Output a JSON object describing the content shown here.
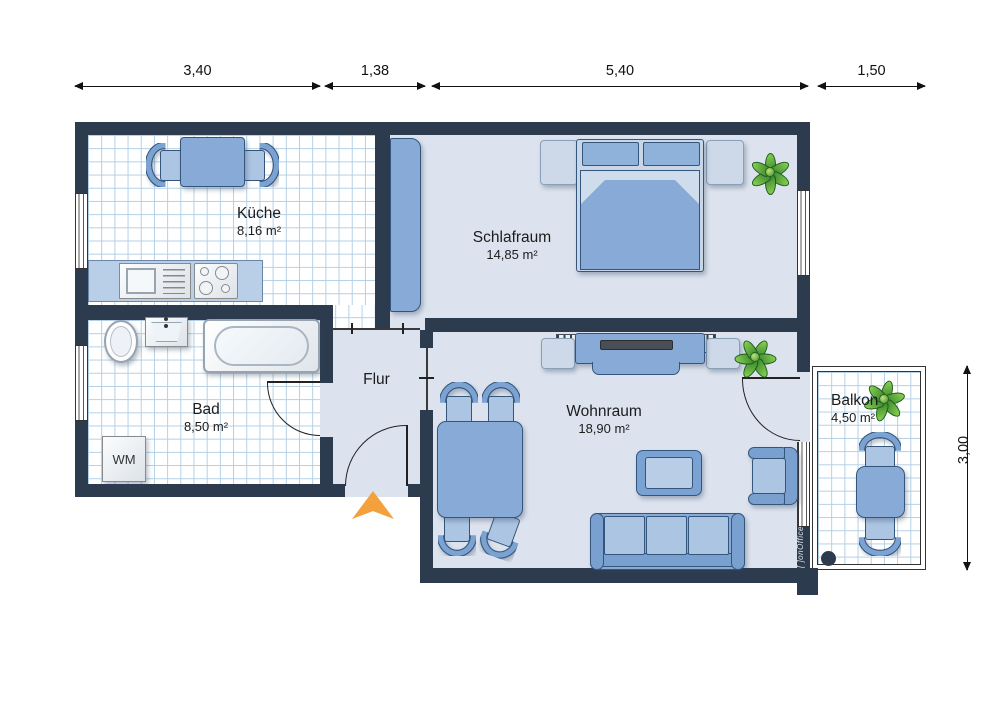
{
  "plan": {
    "dims_top": [
      {
        "label": "3,40"
      },
      {
        "label": "1,38"
      },
      {
        "label": "5,40"
      },
      {
        "label": "1,50"
      }
    ],
    "dim_right": {
      "label": "3,00"
    },
    "rooms": {
      "kueche": {
        "name": "Küche",
        "area": "8,16 m²"
      },
      "schlafraum": {
        "name": "Schlafraum",
        "area": "14,85 m²"
      },
      "bad": {
        "name": "Bad",
        "area": "8,50 m²"
      },
      "flur": {
        "name": "Flur"
      },
      "wohnraum": {
        "name": "Wohnraum",
        "area": "18,90 m²"
      },
      "balkon": {
        "name": "Balkon",
        "area": "4,50 m²"
      }
    },
    "appliances": {
      "washing_machine": "WM"
    },
    "watermark": {
      "prefix": "[ ]",
      "text": "onOffice"
    }
  },
  "colors": {
    "wall": "#2d3b4f",
    "floor_light": "#dce3ee",
    "tile_line": "#b3d0e6",
    "furniture_blue": "#87abd6",
    "furniture_border": "#34567c",
    "entrance_arrow": "#f2a13d",
    "plant_green": "#4f9c3a"
  }
}
